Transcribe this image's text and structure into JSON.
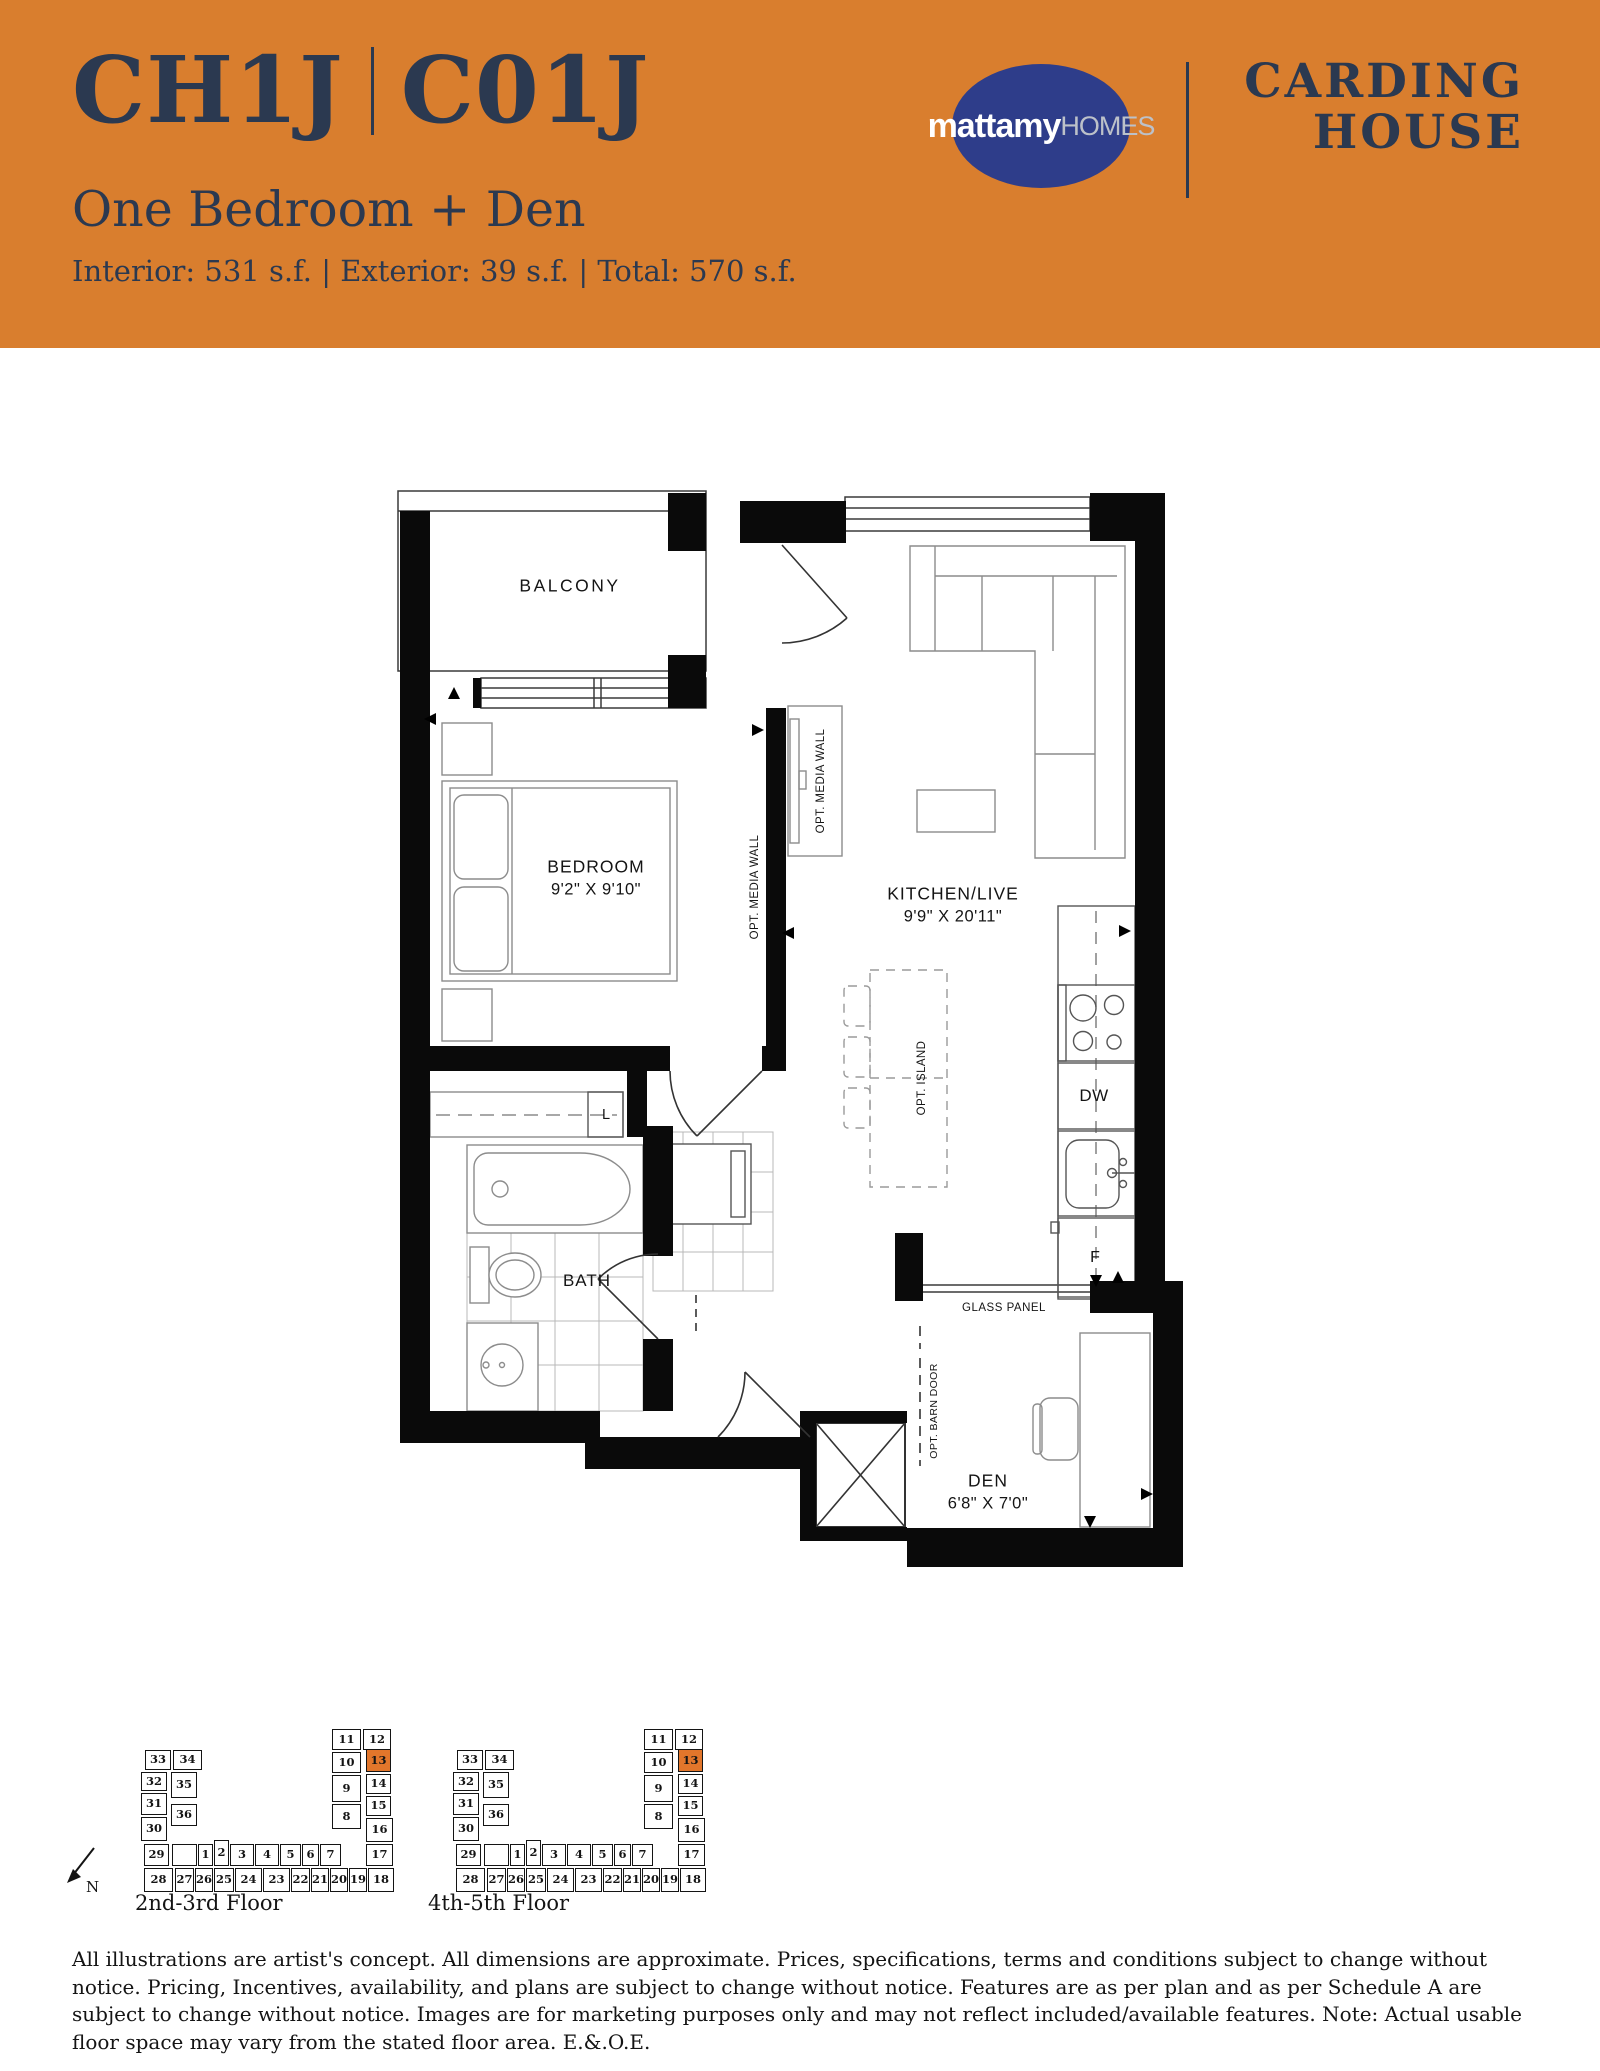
{
  "header": {
    "unit_code_left": "CH1J",
    "unit_code_right": "C01J",
    "unit_name": "One Bedroom + Den",
    "stats": "Interior: 531 s.f. | Exterior: 39 s.f. | Total: 570 s.f.",
    "logo": {
      "word1": "mattamy",
      "word2": "HOMES"
    },
    "project_line1": "CARDING",
    "project_line2": "HOUSE",
    "colors": {
      "band": "#D97E2E",
      "navy": "#2B3950",
      "logo_navy": "#2E3D8A",
      "logo_gray": "#BCC1C9"
    }
  },
  "floor_plan": {
    "labels": {
      "balcony": "BALCONY",
      "bedroom": "BEDROOM",
      "bedroom_dim": "9'2\" X 9'10\"",
      "kitchen": "KITCHEN/LIVE",
      "kitchen_dim": "9'9\" X 20'11\"",
      "media_wall_bedroom": "OPT. MEDIA WALL",
      "media_wall_living": "OPT. MEDIA WALL",
      "island": "OPT. ISLAND",
      "dw": "DW",
      "fridge": "F",
      "linen": "L",
      "bath": "BATH",
      "glass_panel": "GLASS PANEL",
      "barn_door": "OPT. BARN DOOR",
      "den": "DEN",
      "den_dim": "6'8\" X 7'0\""
    }
  },
  "key_plans": {
    "highlight_color": "#E2762B",
    "highlight_unit": "13",
    "north_label": "N",
    "plans": [
      {
        "caption": "2nd-3rd Floor"
      },
      {
        "caption": "4th-5th Floor"
      }
    ],
    "units": [
      {
        "n": "33",
        "x": 35,
        "y": 62,
        "w": 26,
        "h": 20
      },
      {
        "n": "34",
        "x": 63,
        "y": 62,
        "w": 29,
        "h": 20
      },
      {
        "n": "32",
        "x": 31,
        "y": 84,
        "w": 26,
        "h": 19
      },
      {
        "n": "35",
        "x": 61,
        "y": 84,
        "w": 26,
        "h": 26
      },
      {
        "n": "31",
        "x": 31,
        "y": 105,
        "w": 26,
        "h": 22
      },
      {
        "n": "36",
        "x": 61,
        "y": 116,
        "w": 26,
        "h": 22
      },
      {
        "n": "30",
        "x": 31,
        "y": 129,
        "w": 26,
        "h": 24
      },
      {
        "n": "29",
        "x": 34,
        "y": 156,
        "w": 25,
        "h": 22
      },
      {
        "n": "28",
        "x": 34,
        "y": 180,
        "w": 29,
        "h": 24
      },
      {
        "n": "27",
        "x": 65,
        "y": 180,
        "w": 19,
        "h": 24
      },
      {
        "n": "26",
        "x": 85,
        "y": 180,
        "w": 18,
        "h": 24
      },
      {
        "n": "25",
        "x": 104,
        "y": 180,
        "w": 20,
        "h": 24
      },
      {
        "n": "24",
        "x": 125,
        "y": 180,
        "w": 27,
        "h": 24
      },
      {
        "n": "23",
        "x": 153,
        "y": 180,
        "w": 27,
        "h": 24
      },
      {
        "n": "22",
        "x": 181,
        "y": 180,
        "w": 19,
        "h": 24
      },
      {
        "n": "21",
        "x": 201,
        "y": 180,
        "w": 18,
        "h": 24
      },
      {
        "n": "20",
        "x": 220,
        "y": 180,
        "w": 18,
        "h": 24
      },
      {
        "n": "19",
        "x": 239,
        "y": 180,
        "w": 18,
        "h": 24
      },
      {
        "n": "18",
        "x": 258,
        "y": 180,
        "w": 26,
        "h": 24
      },
      {
        "n": "",
        "x": 62,
        "y": 156,
        "w": 25,
        "h": 22
      },
      {
        "n": "1",
        "x": 88,
        "y": 156,
        "w": 15,
        "h": 22
      },
      {
        "n": "2",
        "x": 104,
        "y": 152,
        "w": 15,
        "h": 26
      },
      {
        "n": "3",
        "x": 120,
        "y": 156,
        "w": 24,
        "h": 22
      },
      {
        "n": "4",
        "x": 145,
        "y": 156,
        "w": 24,
        "h": 22
      },
      {
        "n": "5",
        "x": 170,
        "y": 156,
        "w": 21,
        "h": 22
      },
      {
        "n": "6",
        "x": 192,
        "y": 156,
        "w": 17,
        "h": 22
      },
      {
        "n": "7",
        "x": 210,
        "y": 156,
        "w": 21,
        "h": 22
      },
      {
        "n": "11",
        "x": 222,
        "y": 41,
        "w": 29,
        "h": 21
      },
      {
        "n": "12",
        "x": 253,
        "y": 41,
        "w": 28,
        "h": 21
      },
      {
        "n": "10",
        "x": 222,
        "y": 64,
        "w": 29,
        "h": 21
      },
      {
        "n": "13",
        "x": 256,
        "y": 61,
        "w": 25,
        "h": 23,
        "hl": true
      },
      {
        "n": "9",
        "x": 222,
        "y": 87,
        "w": 29,
        "h": 27
      },
      {
        "n": "14",
        "x": 256,
        "y": 86,
        "w": 25,
        "h": 20
      },
      {
        "n": "15",
        "x": 256,
        "y": 108,
        "w": 25,
        "h": 20
      },
      {
        "n": "8",
        "x": 222,
        "y": 116,
        "w": 29,
        "h": 25
      },
      {
        "n": "16",
        "x": 256,
        "y": 130,
        "w": 27,
        "h": 24
      },
      {
        "n": "17",
        "x": 256,
        "y": 156,
        "w": 27,
        "h": 22
      }
    ]
  },
  "disclaimer": "All illustrations are artist's concept. All dimensions are approximate. Prices, specifications, terms and conditions subject to change without notice. Pricing, Incentives, availability, and plans are subject to change without notice. Features are as per plan and as per Schedule A are subject to change without notice. Images are for marketing purposes only and may not reflect included/available features. Note: Actual usable floor space may vary from the stated floor area. E.&.O.E."
}
